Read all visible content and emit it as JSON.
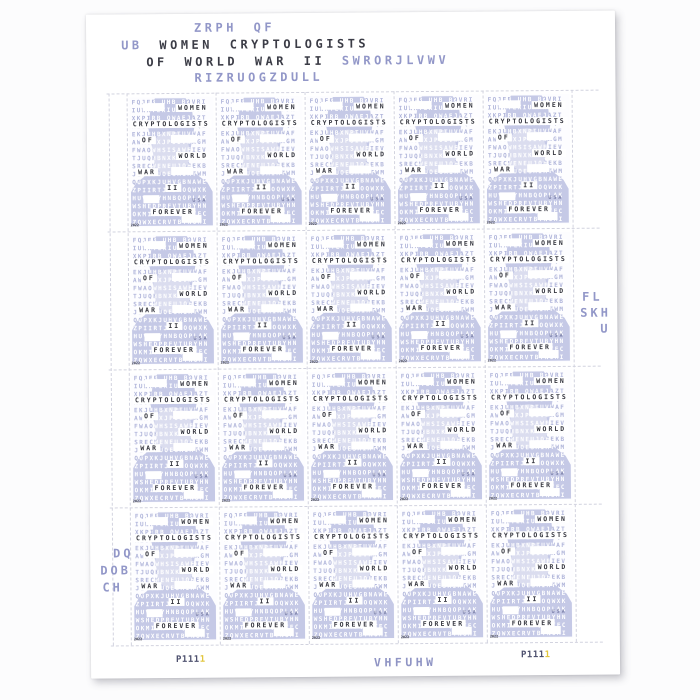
{
  "colors": {
    "accent_purple": "#9297c8",
    "ink_dark": "#3b3c46",
    "lavender": "#c5c9e6",
    "faint_letter": "#b0b5da",
    "plate_dark": "#4c4f6d",
    "plate_yellow": "#e2c63e",
    "perforation": "#d2d3df",
    "paper": "#ffffff"
  },
  "sheet": {
    "stamp_count": 20,
    "grid": {
      "cols": 5,
      "rows": 4
    }
  },
  "header": {
    "cipher_line1": "ZRPH QF",
    "cipher_prefix": "UB",
    "title_line1": "WOMEN CRYPTOLOGISTS",
    "title_line2": "OF WORLD WAR II",
    "cipher_line2": "SWRORJLVWV",
    "cipher_line3": "RIZRUOGZDULL"
  },
  "selvage": {
    "right_lines": {
      "l1": "FL",
      "l2": "SKH",
      "l3": "U"
    },
    "left_lines": {
      "l1": "DQ",
      "l2": "DOB",
      "l3": "CH"
    },
    "bottom_cipher": "VHFUHW",
    "plate_number": "P111",
    "plate_number_yellow_digit": "1"
  },
  "stamp": {
    "words": {
      "women": "WOMEN",
      "cryptologists": "CRYPTOLOGISTS",
      "of": "OF",
      "world": "WORLD",
      "war": "WAR",
      "ii": "II",
      "usa": "USA",
      "forever": "FOREVER",
      "year": "2022"
    },
    "cipher_rows": [
      "FQJEB UHB BOVRI",
      "IUWATEXIUWANTJR",
      "XKPIRB OWAEJAZT",
      "AIOWAPYIRTJWTQE",
      "EKJUHBXNPTUVWAF",
      "AWAOHXJPUIVWAGM",
      "FWAOWHSISAWFIEV",
      "TJUQHBNXKOPYRIA",
      "SRECWENEUJOHEKB",
      "JICYVUOESAIATWM",
      "QOPXKJUHVGBNAWE",
      "ZPIIRTJEJAOQWXK",
      "HUVGTYHNBQOPLAK",
      "WSHEDPRFVTUBYHN",
      "OKMIJNUHBQGVTFC",
      "ZQWXECRVTBYNUMI"
    ]
  }
}
